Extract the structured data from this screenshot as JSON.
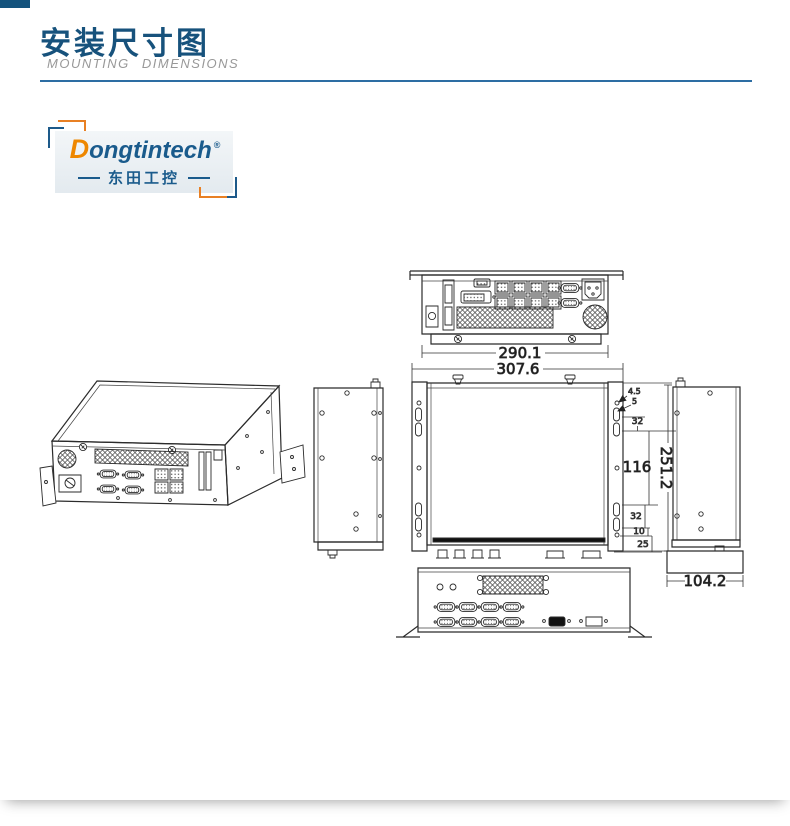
{
  "header": {
    "title_zh": "安装尺寸图",
    "title_en": "MOUNTING  DIMENSIONS"
  },
  "logo": {
    "brand_initial": "D",
    "brand_rest": "ongtintech",
    "registered_mark": "®",
    "brand_cn": "东田工控"
  },
  "drawing": {
    "dims": {
      "rear_width": "290.1",
      "overall_width": "307.6",
      "overall_depth": "251.2",
      "mount_hole_dia": "4.5",
      "mount_slot_width": "5",
      "slot_pitch_top": "32",
      "mid_span": "116",
      "slot_pitch_bottom": "32",
      "hole_gap": "10",
      "edge_gap": "25",
      "side_width": "104.2"
    }
  },
  "colors": {
    "accent_blue": "#17527c",
    "logo_blue": "#1a5b8c",
    "logo_orange": "#ee8700",
    "rule_blue": "#2d6da3",
    "subtitle_gray": "#989898",
    "line_black": "#2b2b2b"
  }
}
